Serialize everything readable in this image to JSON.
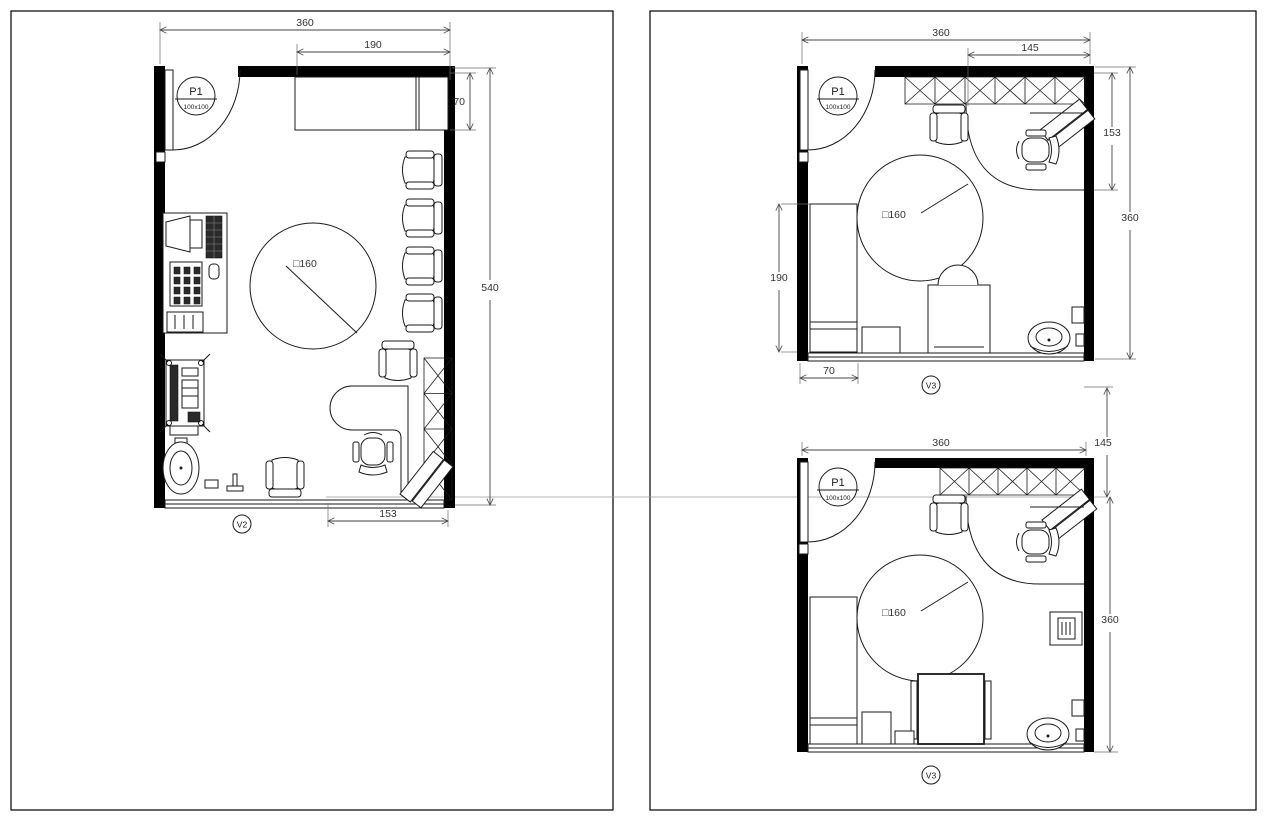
{
  "colors": {
    "background": "#ffffff",
    "line": "#1a1a1a",
    "wall": "#000000",
    "dim_text": "#333333"
  },
  "left_plan": {
    "door": {
      "tag": "P1",
      "size": "100x100"
    },
    "window_tag": "V2",
    "table_label": "□160",
    "dims": {
      "top": "360",
      "top_inner": "190",
      "right_upper": "70",
      "right_total": "540",
      "bottom": "153"
    }
  },
  "top_right_plan": {
    "door": {
      "tag": "P1",
      "size": "100x100"
    },
    "window_tag": "V3",
    "table_label": "□160",
    "dims": {
      "top": "360",
      "top_inner": "145",
      "left": "190",
      "bottom_left": "70",
      "right_upper": "153",
      "right_total": "360"
    }
  },
  "bottom_right_plan": {
    "door": {
      "tag": "P1",
      "size": "100x100"
    },
    "window_tag": "V3",
    "table_label": "□160",
    "dims": {
      "top": "360",
      "right_gap": "145",
      "right_total": "360"
    }
  }
}
